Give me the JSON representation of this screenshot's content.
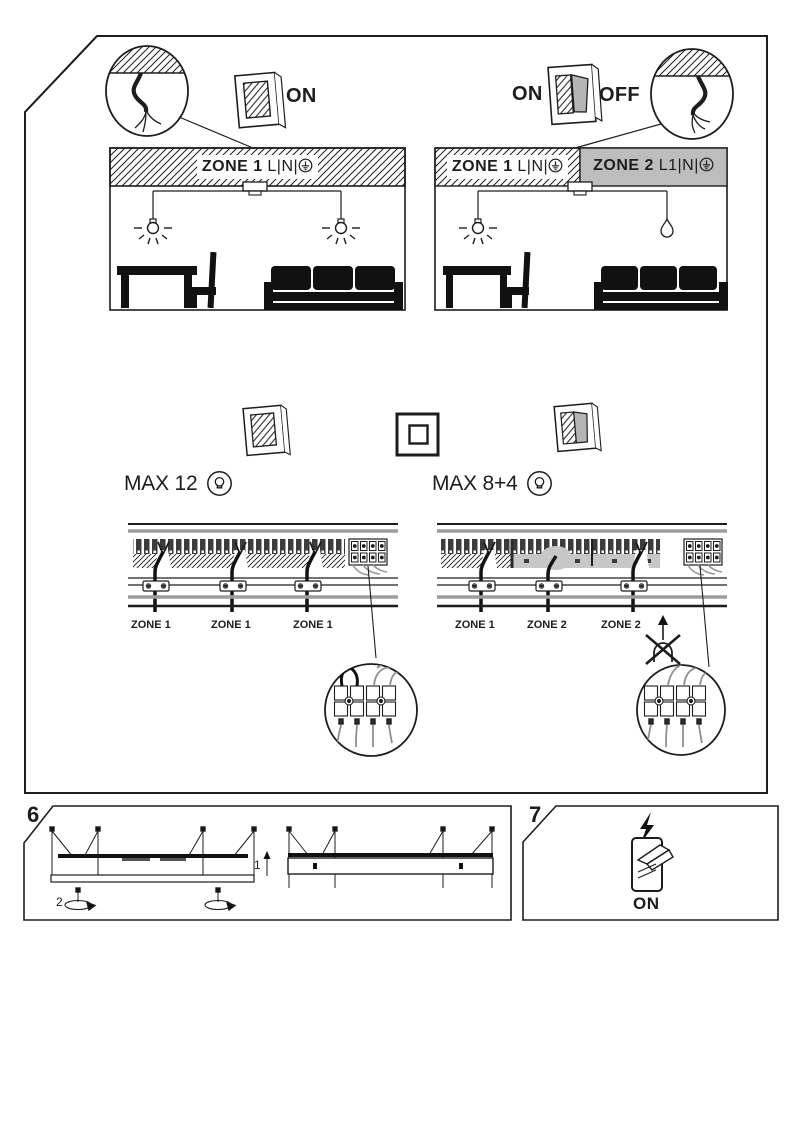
{
  "page": {
    "type": "lighting installation manual page"
  },
  "colors": {
    "ink": "#1d1d1b",
    "zone2_fill": "#bdbdbd",
    "band_gray": "#c7c7c7",
    "rail_gray": "#9d9d9c"
  },
  "rooms": {
    "left": {
      "switch_on": "ON",
      "zone": "ZONE 1",
      "terminals": "L|N|"
    },
    "right": {
      "switch_on": "ON",
      "switch_off": "OFF",
      "zone1": "ZONE 1",
      "zone1_terminals": "L|N|",
      "zone2": "ZONE 2",
      "zone2_terminals": "L1|N|"
    }
  },
  "wiring": {
    "left": {
      "max": "MAX 12",
      "zones": [
        "ZONE 1",
        "ZONE 1",
        "ZONE 1"
      ]
    },
    "right": {
      "max": "MAX 8+4",
      "zones": [
        "ZONE 1",
        "ZONE 2",
        "ZONE 2"
      ]
    }
  },
  "steps": {
    "six": {
      "number": "6",
      "marker1": "1",
      "marker2": "2"
    },
    "seven": {
      "number": "7",
      "on": "ON"
    }
  },
  "icons": {
    "earth": "earth-ground-icon",
    "bulb": "bulb-in-circle-icon",
    "lightning": "lightning-bolt-icon",
    "up_arrow": "up-arrow-icon",
    "no_pull": "crossed-out-gland-icon",
    "rotate": "rotate-arrow-icon"
  }
}
